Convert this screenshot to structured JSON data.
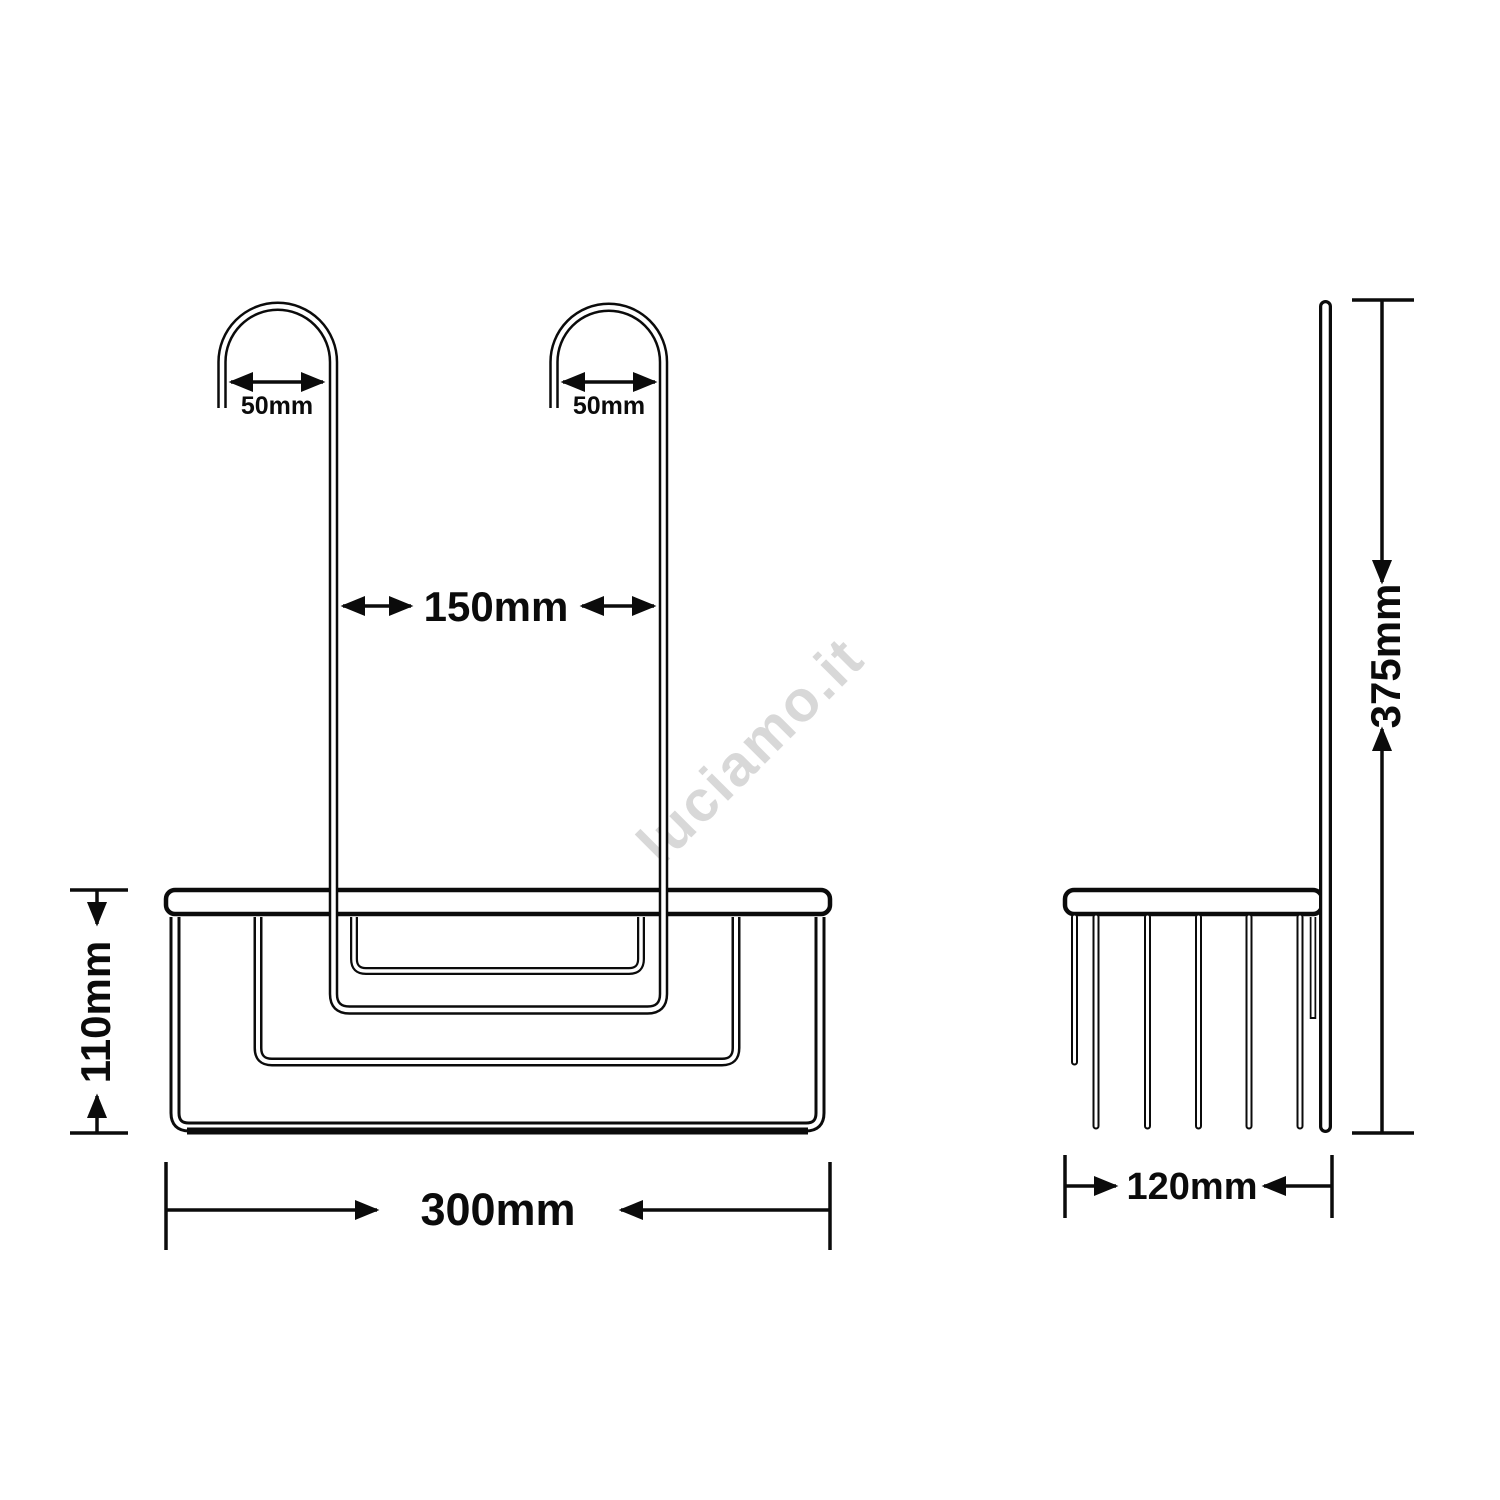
{
  "drawing": {
    "background_color": "#ffffff",
    "line_color": "#0b0b0b",
    "watermark": {
      "text": "luciamo.it",
      "color": "#d8d8d8"
    },
    "front_view": {
      "name": "front view of hanging shower basket",
      "dimensions": {
        "hook_inner_width_left": "50mm",
        "hook_inner_width_right": "50mm",
        "hook_spacing": "150mm",
        "basket_height": "110mm",
        "basket_width": "300mm"
      }
    },
    "side_view": {
      "name": "side view of hanging shower basket",
      "dimensions": {
        "basket_depth": "120mm",
        "hanger_height": "375mm"
      }
    }
  }
}
